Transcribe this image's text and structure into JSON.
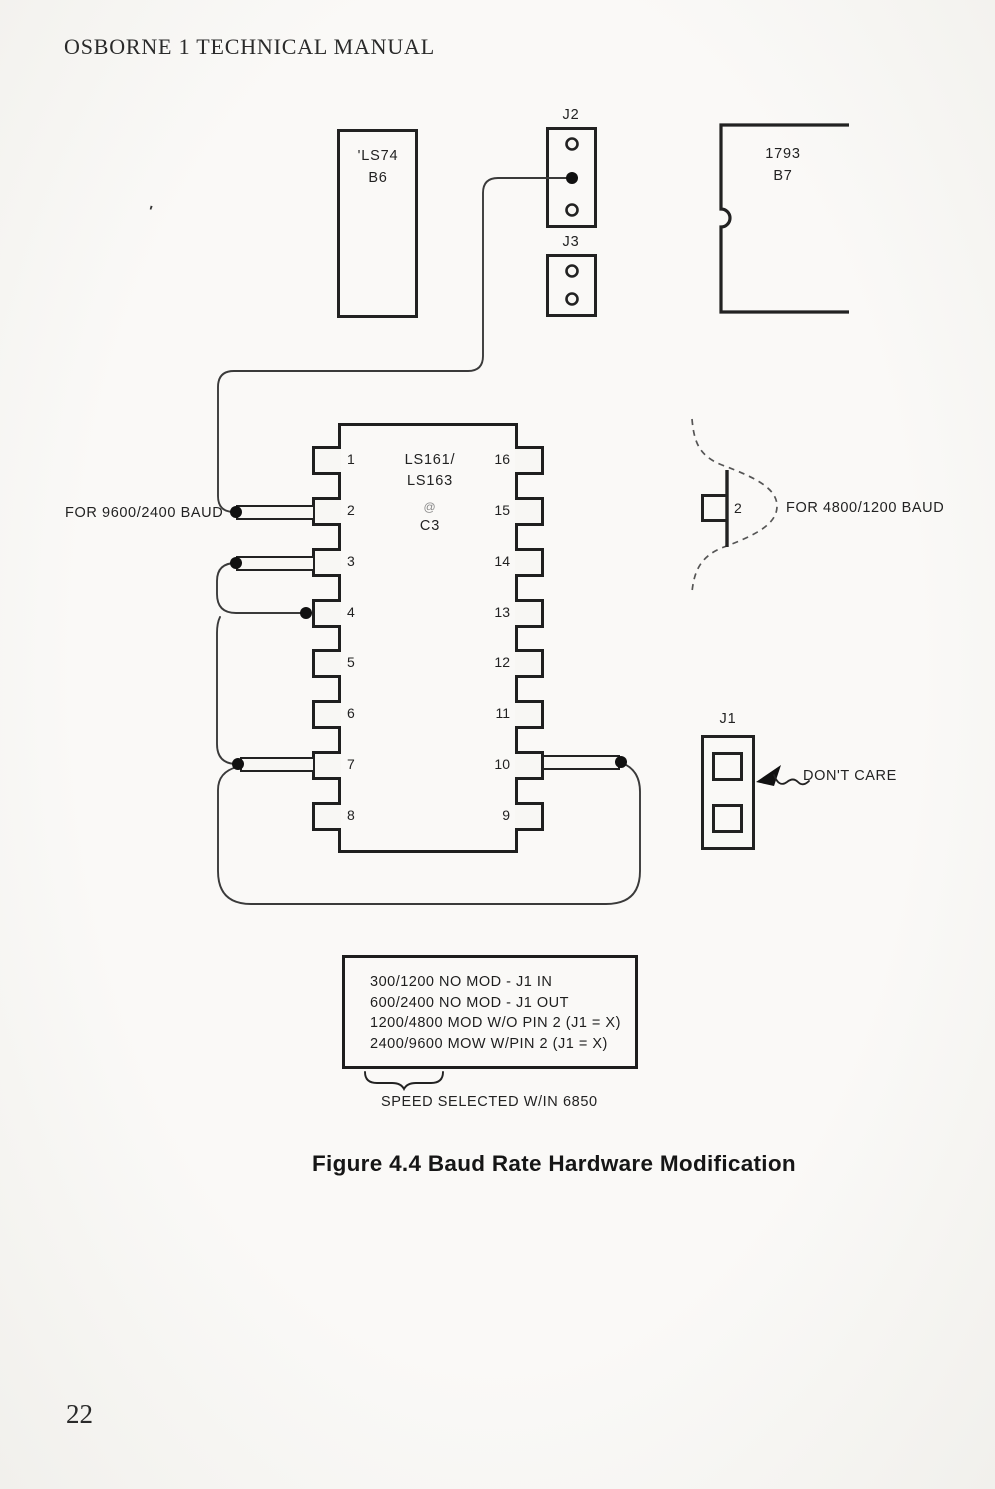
{
  "header": {
    "title": "OSBORNE 1 TECHNICAL MANUAL"
  },
  "footer": {
    "page_number": "22"
  },
  "figure": {
    "caption": "Figure 4.4 Baud Rate Hardware Modification",
    "artifact_mark": "'",
    "chips": {
      "ls74": {
        "name": "'LS74",
        "location": "B6"
      },
      "fdc1793": {
        "name": "1793",
        "location": "B7"
      },
      "counter": {
        "name_line1": "LS161/",
        "name_line2": "LS163",
        "at_symbol": "@",
        "location": "C3",
        "left_pins": [
          "1",
          "2",
          "3",
          "4",
          "5",
          "6",
          "7",
          "8"
        ],
        "right_pins": [
          "16",
          "15",
          "14",
          "13",
          "12",
          "11",
          "10",
          "9"
        ]
      }
    },
    "jumpers": {
      "j1": "J1",
      "j2": "J2",
      "j3": "J3"
    },
    "labels": {
      "baud_9600_2400": "FOR 9600/2400 BAUD",
      "baud_4800_1200": "FOR 4800/1200 BAUD",
      "dont_care": "DON'T CARE",
      "detail_pin_number": "2",
      "speed_selected": "SPEED SELECTED W/IN 6850"
    },
    "mod_options": [
      "300/1200 NO MOD - J1 IN",
      "600/2400 NO MOD - J1 OUT",
      "1200/4800 MOD W/O PIN 2 (J1 = X)",
      "2400/9600 MOW W/PIN 2 (J1 = X)"
    ]
  }
}
